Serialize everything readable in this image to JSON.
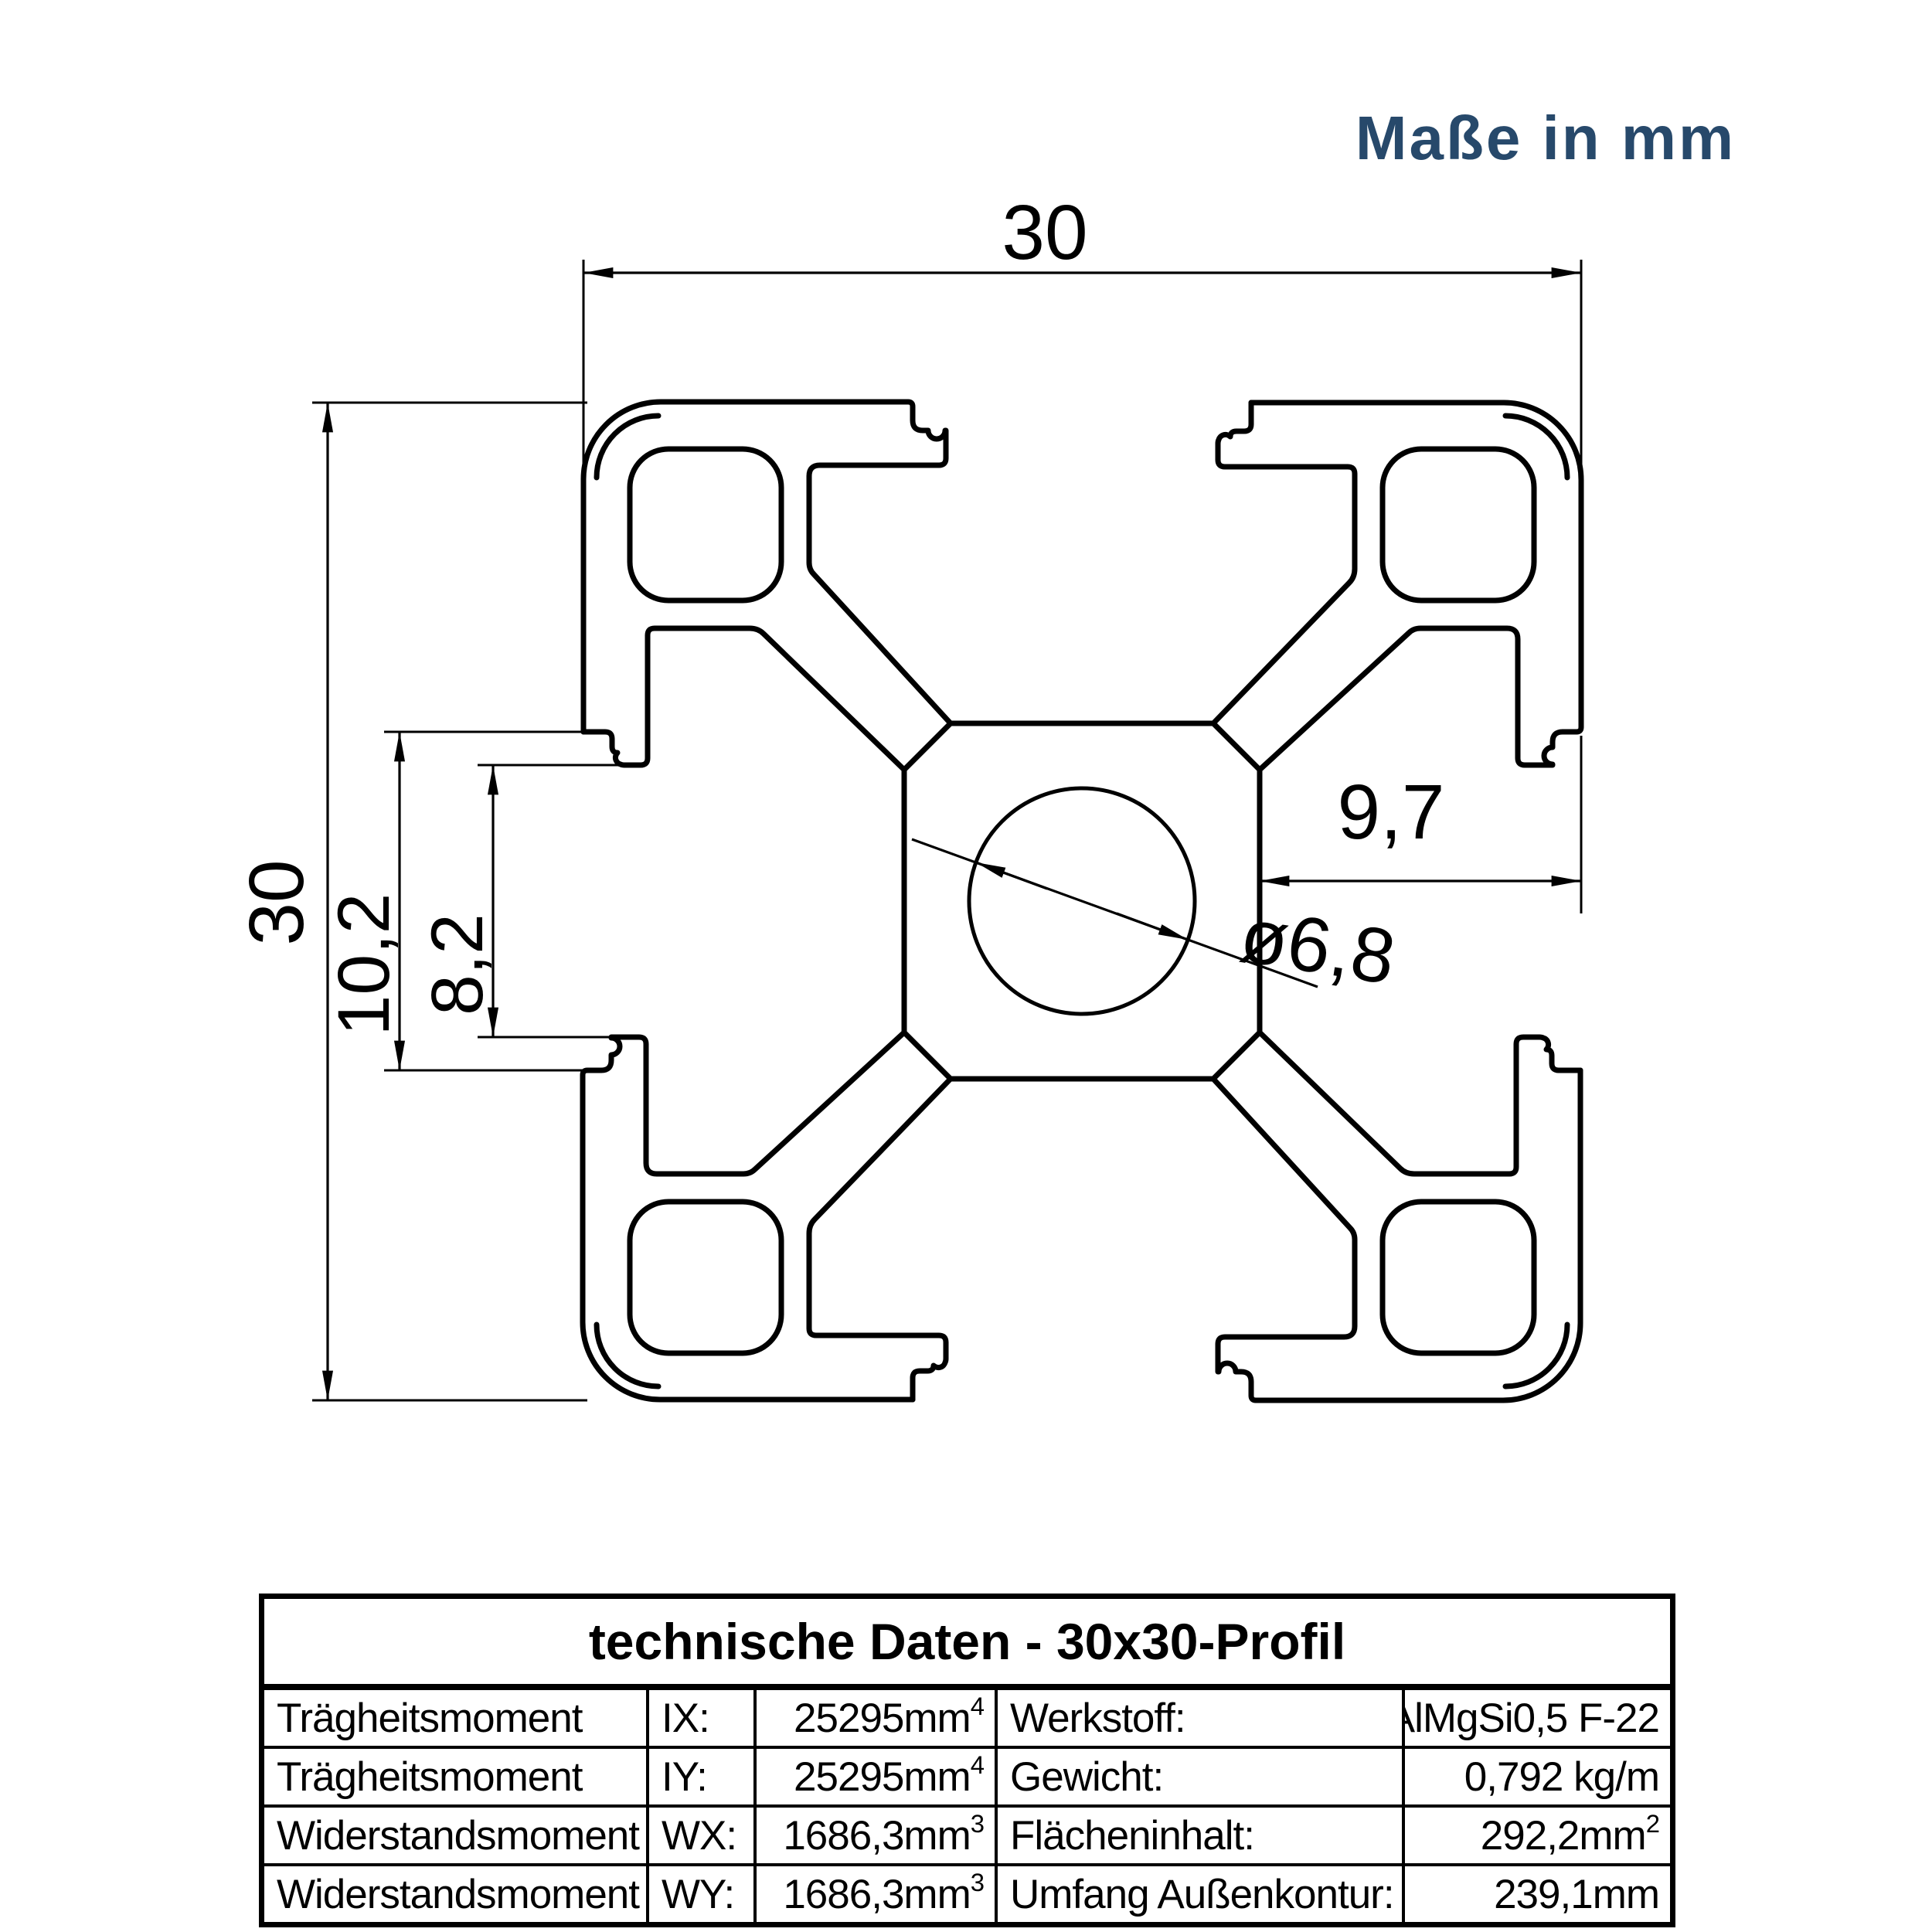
{
  "note": "Maße in mm",
  "colors": {
    "accent": "#27496B",
    "line": "#000000"
  },
  "drawing": {
    "dim_width": "30",
    "dim_height": "30",
    "dim_slot_outer": "10,2",
    "dim_slot_inner": "8,2",
    "dim_core_depth": "9,7",
    "dim_bore": "ø6,8"
  },
  "table": {
    "title": "technische Daten - 30x30-Profil",
    "rows": [
      {
        "c1": "Trägheitsmoment",
        "c2": "IX:",
        "c3": "25295mm",
        "c3sup": "4",
        "c4": "Werkstoff:",
        "c5": "AlMgSi0,5 F-22",
        "c5sup": ""
      },
      {
        "c1": "Trägheitsmoment",
        "c2": "IY:",
        "c3": "25295mm",
        "c3sup": "4",
        "c4": "Gewicht:",
        "c5": "0,792 kg/m",
        "c5sup": ""
      },
      {
        "c1": "Widerstandsmoment",
        "c2": "WX:",
        "c3": "1686,3mm",
        "c3sup": "3",
        "c4": "Flächeninhalt:",
        "c5": "292,2mm",
        "c5sup": "2"
      },
      {
        "c1": "Widerstandsmoment",
        "c2": "WY:",
        "c3": "1686,3mm",
        "c3sup": "3",
        "c4": "Umfang Außenkontur:",
        "c5": "239,1mm",
        "c5sup": ""
      }
    ]
  }
}
